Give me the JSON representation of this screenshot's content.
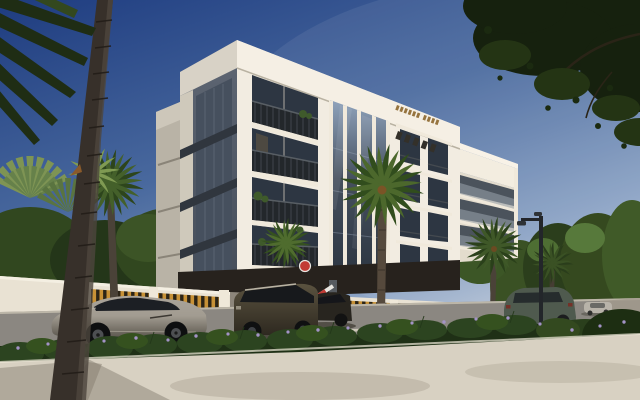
{
  "scene": {
    "kind": "photoreal-architectural-render",
    "subject": "modern five-storey white apartment building with balconies",
    "setting": "sunny palm-lined street, deep blue sky",
    "building_storeys": 5,
    "sign": "small gold lettering on upper fascia (not legible)",
    "vehicles": [
      "grey sports coupe",
      "dark SUV exiting driveway",
      "dark sedan",
      "green SUV driving away",
      "distant silver car"
    ],
    "vegetation": [
      "foreground palm trunk",
      "fan palms",
      "date palms",
      "street hedge with purple flowers",
      "overhanging tree canopy"
    ],
    "street_furniture": [
      "perimeter wall with gold slats",
      "parking boom barrier with red disc",
      "street light"
    ]
  },
  "colors": {
    "sky_top": "#1e3c80",
    "sky_mid": "#49699e",
    "sky_low": "#8aa2c4",
    "sky_horizon": "#c8d0dc",
    "facade_white": "#f2ece1",
    "facade_shade": "#e3dccd",
    "fascia_white": "#f5efe4",
    "west_gray": "#5f6774",
    "west_dark": "#454d59",
    "glass_dark": "#2d3642",
    "glass_mid": "#46505e",
    "glass_light": "#8fa3bc",
    "railing_dark": "#23272b",
    "slab_white": "#f0e9db",
    "sign_gold": "#96743f",
    "wall_white": "#e9e2d3",
    "slat_gold": "#c79136",
    "slat_dark": "#2b2416",
    "soffit_dark": "#27221d",
    "road_gray": "#8b8781",
    "road_light": "#a29b8d",
    "curb_white": "#d8d2c2",
    "sidewalk_light": "#d8d1c2",
    "sidewalk_shadow": "#8f887b",
    "hedge_green": "#2c4420",
    "hedge_dark": "#1f3016",
    "flower_purple": "#a393c6",
    "palm_green": "#4c682c",
    "palm_dark": "#314d1d",
    "fan_palm": "#7e9454",
    "trunk_dark": "#37302a",
    "trunk_light": "#4e463d",
    "foliage_dark": "#16210e",
    "tree_green": "#31471f",
    "tree_bright": "#486831",
    "distant_tan": "#968b78",
    "car_silver": "#a29c91",
    "car_dark_suv": "#453e34",
    "car_sedan_dark": "#28251f",
    "car_green_suv": "#4f5a4e",
    "barrier_red": "#c23b35",
    "barrier_white": "#e8e6e0",
    "pole_dark": "#23262a"
  }
}
